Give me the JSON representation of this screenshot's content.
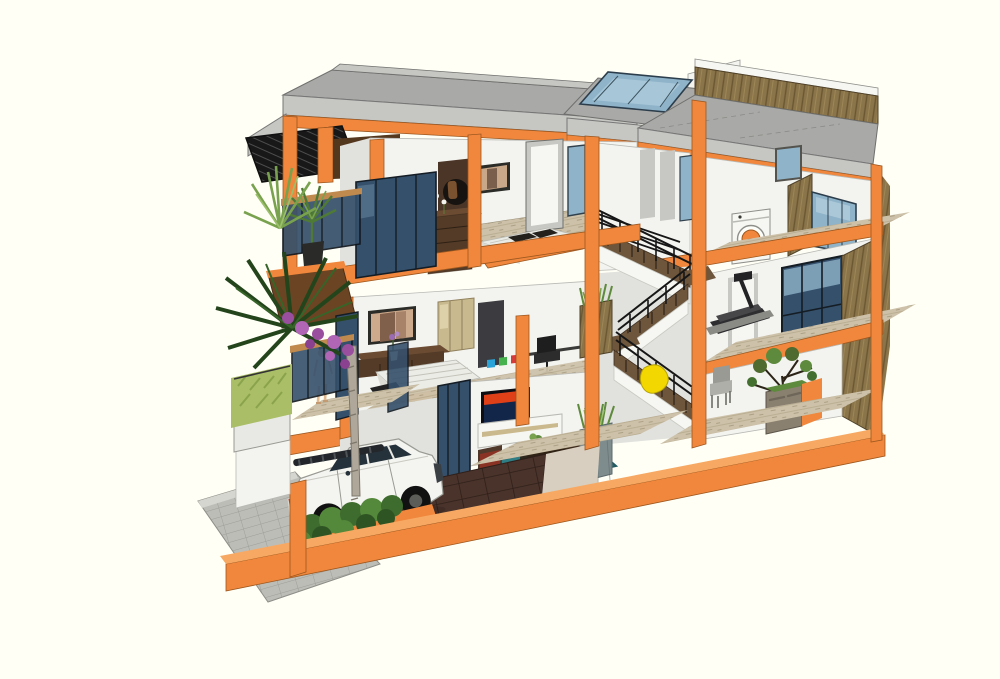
{
  "meta": {
    "title": "3D cutaway section of a three-storey townhouse",
    "description": "SketchUp-style architectural section render of a narrow three-storey house with an orange cut structural frame, grey flat roofs, a blue roof skylight, a central dog-leg wooden staircase with black railings, furnished interiors, a white SUV parked in the garage, palm trees and planters at the street side, and a person standing on a balcony.",
    "render_style": "sketchup cutaway model",
    "background_color": "#fffff6"
  },
  "palette": {
    "orange": "#f0873c",
    "orangeDark": "#c96f2b",
    "orangeLight": "#f7a963",
    "roofGray": "#a9a9a7",
    "roofLight": "#c6c6c3",
    "wallWhite": "#f3f3ef",
    "wallShade": "#e1e1dd",
    "wallDark": "#c7c7c3",
    "floorWood": "#cdc2a9",
    "floorWoodDark": "#b2a78c",
    "glassBlue": "#8fb3c9",
    "glassLight": "#bcd6e3",
    "glassNavy": "#35506b",
    "woodWallBrown": "#8a744a",
    "stairTread": "#6e563d",
    "furnitureWood": "#543b27",
    "rugTeal": "#2f7e86",
    "tileBrown": "#4a332a",
    "paverGray": "#bdbdb8",
    "hedgeGreen": "#a9be66",
    "plantGreen": "#5d8a3c",
    "plantDark": "#24451c",
    "plantLight": "#79a24e",
    "beanbagYellow": "#f2d800",
    "carWhite": "#f4f4f0",
    "skin": "#e3b98f",
    "ink": "#1a1a1a"
  },
  "scene": {
    "floors": [
      {
        "level": "ground",
        "rooms": [
          "garage with white SUV and dark brown tiled floor",
          "living room with colourful TV, white media console, teal rug, dark wood coffee table and stools",
          "double-height dining space with grey chair, stone planter and indoor tree",
          "yellow beanbag by the stairs"
        ]
      },
      {
        "level": "second",
        "rooms": [
          "master bedroom with wall photo, low TV console, flower vase and white bed on orange platform",
          "wardrobe and desk nook with black office chair",
          "gym corner with treadmill",
          "balcony with glass balustrade, brown awning and standing figure"
        ]
      },
      {
        "level": "third",
        "rooms": [
          "bedroom with dark wood altar cabinet, round wall panel, framed couple photo and white bed",
          "laundry nook with orange-door washing machine",
          "balcony with potted palm"
        ]
      },
      {
        "level": "roof",
        "rooms": [
          "grey flat roof decks",
          "blue glass skylight over stairwell",
          "timber-clad parapet roof terrace",
          "glass stair bulkhead"
        ]
      }
    ],
    "objects": [
      "orange cut structural frame",
      "grey flat roof slabs",
      "blue skylight",
      "timber parapet",
      "dog-leg wooden staircase with black steel railings",
      "washing machine",
      "treadmill",
      "double bed (third floor)",
      "altar cabinet",
      "framed couple photo (third floor)",
      "master bed (second floor)",
      "TV console with flower vase",
      "framed couple photo (second floor)",
      "office chair and desk",
      "wardrobe",
      "smart TV with colourful screen",
      "white TV cabinet",
      "coffee table with plant",
      "teal rug",
      "wooden stools",
      "red-cushion chair",
      "planter with tall grass",
      "grey dining chair",
      "stone-clad planter",
      "indoor tree",
      "yellow beanbag",
      "white SUV",
      "dark brown garage tiles",
      "grey paver sidewalk",
      "palm trees",
      "bougainvillea",
      "hedge planter",
      "shrub planter",
      "balcony palm",
      "person in white dress on balcony",
      "dark slatted awning",
      "brown awning",
      "navy glass sliding doors",
      "blue window wall",
      "glass stair bulkhead"
    ],
    "vehicle": {
      "type": "SUV",
      "color": "white",
      "location": "garage, facing right"
    },
    "person": {
      "pose": "standing",
      "clothing": "white dress",
      "location": "second-floor balcony"
    }
  }
}
